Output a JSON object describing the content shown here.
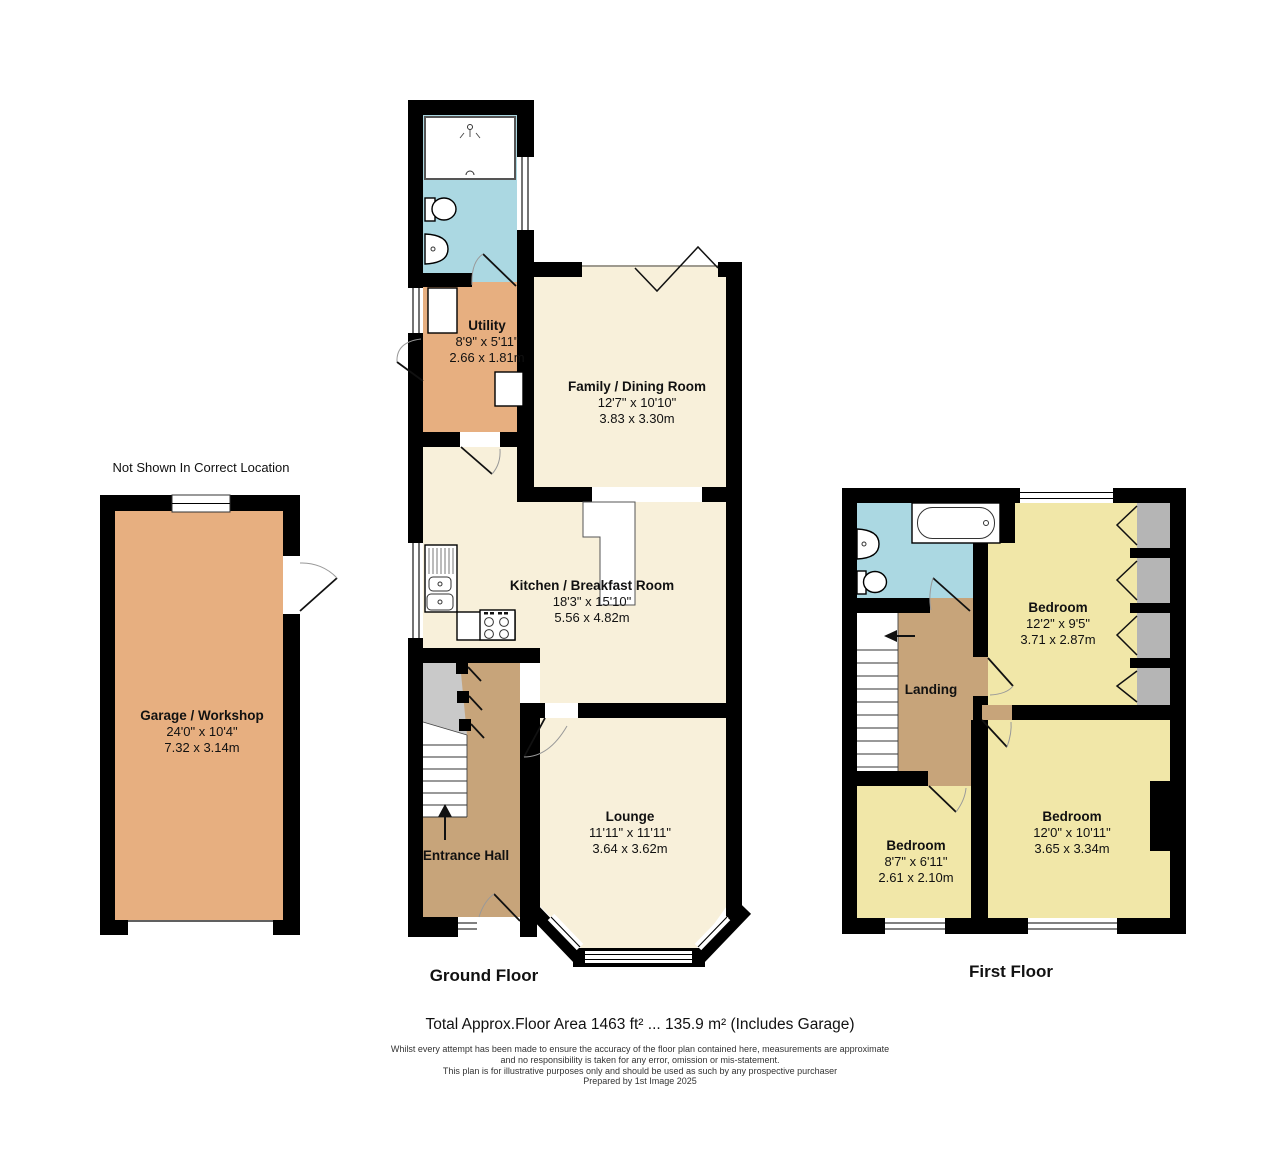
{
  "note": "Not Shown In Correct Location",
  "colors": {
    "wall": "#000000",
    "cream": "#f8f0da",
    "tan": "#e7af80",
    "hallTan": "#c7a47a",
    "yellow": "#f1e7a8",
    "blue": "#abd8e2",
    "wardrobe": "#b5b5b5",
    "underStair": "#c9c9c9"
  },
  "garage": {
    "name": "Garage / Workshop",
    "imperial": "24'0\" x 10'4\"",
    "metric": "7.32 x 3.14m"
  },
  "ground": {
    "title": "Ground Floor",
    "rooms": {
      "utility": {
        "name": "Utility",
        "imperial": "8'9\" x 5'11\"",
        "metric": "2.66 x 1.81m"
      },
      "family": {
        "name": "Family / Dining Room",
        "imperial": "12'7\" x 10'10\"",
        "metric": "3.83 x 3.30m"
      },
      "kitchen": {
        "name": "Kitchen / Breakfast Room",
        "imperial": "18'3\" x 15'10\"",
        "metric": "5.56 x 4.82m"
      },
      "lounge": {
        "name": "Lounge",
        "imperial": "11'11\" x 11'11\"",
        "metric": "3.64 x 3.62m"
      },
      "hall": {
        "name": "Entrance Hall"
      }
    }
  },
  "first": {
    "title": "First Floor",
    "rooms": {
      "landing": {
        "name": "Landing"
      },
      "bedroom1": {
        "name": "Bedroom",
        "imperial": "12'2\" x 9'5\"",
        "metric": "3.71 x 2.87m"
      },
      "bedroom2": {
        "name": "Bedroom",
        "imperial": "12'0\" x 10'11\"",
        "metric": "3.65 x 3.34m"
      },
      "bedroom3": {
        "name": "Bedroom",
        "imperial": "8'7\" x 6'11\"",
        "metric": "2.61 x 2.10m"
      }
    }
  },
  "footer": {
    "total": "Total Approx.Floor Area 1463 ft² ... 135.9 m² (Includes Garage)",
    "disclaimer": [
      "Whilst every attempt has been made to ensure the accuracy of the floor plan contained here, measurements are approximate",
      "and no responsibility is taken for any error, omission or mis-statement.",
      "This plan is for illustrative purposes only and should be used as such by any prospective purchaser",
      "Prepared by 1st Image 2025"
    ]
  }
}
